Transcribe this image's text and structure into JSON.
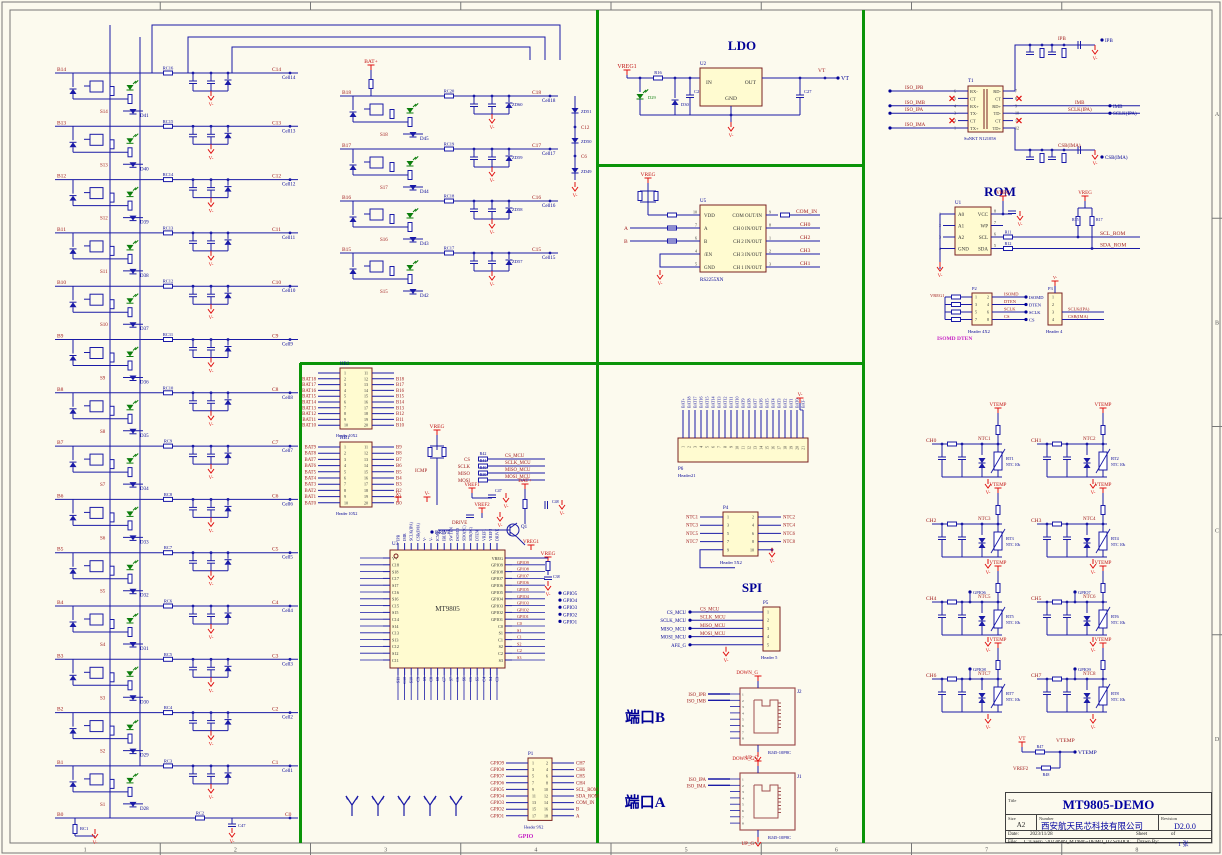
{
  "frame": {
    "bottom_zones": [
      "1",
      "2",
      "3",
      "4",
      "5",
      "6",
      "7",
      "8"
    ],
    "right_zones": [
      "A",
      "B",
      "C",
      "D"
    ]
  },
  "title_block": {
    "title_label": "Title",
    "title": "MT9805-DEMO",
    "size_label": "Size",
    "size": "A2",
    "number_label": "Number",
    "number": "西安航天民芯科技有限公司",
    "revision_label": "Revision",
    "revision": "D2.0.0",
    "date_label": "Date:",
    "date": "2023/11/28",
    "sheet_label": "Sheet",
    "of_label": "of",
    "file_label": "File:",
    "file": "C:\\Users\\..\\20230909_MT9805-DEMO_D2.SchDOC",
    "drawn_label": "Drawn By:",
    "drawn": "1 张"
  },
  "left_stack": {
    "rows": [
      {
        "bus": "B14",
        "s": "S14",
        "d": "D41",
        "rc": "RC16",
        "net": "C14",
        "cell": "Cell14"
      },
      {
        "bus": "B13",
        "s": "S13",
        "d": "D40",
        "rc": "RC15",
        "net": "C13",
        "cell": "Cell13"
      },
      {
        "bus": "B12",
        "s": "S12",
        "d": "D39",
        "rc": "RC14",
        "net": "C12",
        "cell": "Cell12"
      },
      {
        "bus": "B11",
        "s": "S11",
        "d": "D38",
        "rc": "RC13",
        "net": "C11",
        "cell": "Cell11"
      },
      {
        "bus": "B10",
        "s": "S10",
        "d": "D37",
        "rc": "RC12",
        "net": "C10",
        "cell": "Cell10"
      },
      {
        "bus": "B9",
        "s": "S9",
        "d": "D36",
        "rc": "RC11",
        "net": "C9",
        "cell": "Cell9"
      },
      {
        "bus": "B8",
        "s": "S8",
        "d": "D35",
        "rc": "RC10",
        "net": "C8",
        "cell": "Cell8"
      },
      {
        "bus": "B7",
        "s": "S7",
        "d": "D34",
        "rc": "RC9",
        "net": "C7",
        "cell": "Cell7"
      },
      {
        "bus": "B6",
        "s": "S6",
        "d": "D33",
        "rc": "RC8",
        "net": "C6",
        "cell": "Cell6"
      },
      {
        "bus": "B5",
        "s": "S5",
        "d": "D32",
        "rc": "RC7",
        "net": "C5",
        "cell": "Cell5"
      },
      {
        "bus": "B4",
        "s": "S4",
        "d": "D31",
        "rc": "RC6",
        "net": "C4",
        "cell": "Cell4"
      },
      {
        "bus": "B3",
        "s": "S3",
        "d": "D30",
        "rc": "RC5",
        "net": "C3",
        "cell": "Cell3"
      },
      {
        "bus": "B2",
        "s": "S2",
        "d": "D29",
        "rc": "RC4",
        "net": "C2",
        "cell": "Cell2"
      },
      {
        "bus": "B1",
        "s": "S1",
        "d": "D28",
        "rc": "RC3",
        "net": "C1",
        "cell": "Cell1"
      }
    ],
    "b0": {
      "bus": "B0",
      "rc1": "RC1",
      "rc2": "RC2",
      "c47": "C47",
      "net": "C0",
      "gnd": "V-"
    }
  },
  "col2": {
    "bat": "BAT+",
    "rows": [
      {
        "bus": "B18",
        "s": "S18",
        "d": "D45",
        "rc": "RC20",
        "net": "C18",
        "cell": "Cell18",
        "zd": "ZD60"
      },
      {
        "bus": "B17",
        "s": "S17",
        "d": "D44",
        "rc": "RC19",
        "net": "C17",
        "cell": "Cell17",
        "zd": "ZD59"
      },
      {
        "bus": "B16",
        "s": "S16",
        "d": "D43",
        "rc": "RC18",
        "net": "C16",
        "cell": "Cell16",
        "zd": "ZD58"
      },
      {
        "bus": "B15",
        "s": "S15",
        "d": "D42",
        "rc": "RC17",
        "net": "C15",
        "cell": "Cell15",
        "zd": "ZD57"
      }
    ],
    "chain": {
      "zds": [
        "ZD51",
        "ZD50",
        "ZD49"
      ],
      "taps": [
        "C12",
        "C6"
      ],
      "gnd": "V-"
    }
  },
  "ldo": {
    "title": "LDO",
    "ref": "U2",
    "pin_in": "IN",
    "pin_out": "OUT",
    "pin_gnd": "GND",
    "in_net": "VREG1",
    "out_net": "VT",
    "out_port": "VT",
    "r": "R16",
    "led": "D29",
    "zener": "D30",
    "c1": "C26",
    "c2": "C27",
    "gnd": "V-"
  },
  "mux": {
    "ref": "U5",
    "part": "RS2255XN",
    "vdd_net": "VREG",
    "a_net": "A",
    "b_net": "B",
    "gnd": "V-",
    "left_pins": [
      [
        "10",
        "VDD"
      ],
      [
        "7",
        "A"
      ],
      [
        "6",
        "B"
      ],
      [
        "4",
        "/EN"
      ],
      [
        "5",
        "GND"
      ]
    ],
    "right_pins": [
      [
        "9",
        "COM OUT/IN"
      ],
      [
        "8",
        "CH 0 IN/OUT"
      ],
      [
        "1",
        "CH 2 IN/OUT"
      ],
      [
        "2",
        "CH 3 IN/OUT"
      ],
      [
        "3",
        "CH 1 IN/OUT"
      ]
    ],
    "right_nets": [
      "COM_IN",
      "CH0",
      "CH2",
      "CH3",
      "CH1"
    ]
  },
  "xfmr": {
    "ref": "T1",
    "part": "SuNKT N12105S",
    "left_pins": [
      [
        "6",
        "RX-"
      ],
      [
        "5",
        "CT"
      ],
      [
        "4",
        "RX+"
      ],
      [
        "3",
        "TX-"
      ],
      [
        "2",
        "CT"
      ],
      [
        "1",
        "TX+"
      ]
    ],
    "right_pins": [
      [
        "7",
        "RD-"
      ],
      [
        "8",
        "CT"
      ],
      [
        "9",
        "RD+"
      ],
      [
        "10",
        "TD-"
      ],
      [
        "11",
        "CT"
      ],
      [
        "12",
        "TD+"
      ]
    ],
    "left_nets": [
      "ISO_IPB",
      "ISO_IMB",
      "ISO_IPA",
      "ISO_IMA"
    ],
    "right_nets": [
      "IPB",
      "IMB",
      "SCLK(IPA)",
      "CSB(IMA)"
    ],
    "gnd": "V-"
  },
  "rom": {
    "title": "ROM",
    "ref": "U1",
    "left_pins": [
      [
        "1",
        "A0"
      ],
      [
        "2",
        "A1"
      ],
      [
        "3",
        "A2"
      ],
      [
        "4",
        "GND"
      ]
    ],
    "right_pins": [
      [
        "8",
        "VCC"
      ],
      [
        "7",
        "WP"
      ],
      [
        "6",
        "SCL"
      ],
      [
        "5",
        "SDA"
      ]
    ],
    "vreg": "VREG",
    "r_scl": "R11",
    "r_sda": "R12",
    "r_pu1": "R15",
    "r_pu2": "R17",
    "net_scl": "SCL_ROM",
    "net_sda": "SDA_ROM",
    "gnd": "V-"
  },
  "iso_hdrs": {
    "p2": {
      "ref": "P2",
      "part": "Header 4X2",
      "nets": [
        "ISOMD",
        "DTEN",
        "SCLK",
        "CS"
      ],
      "left_net": "VREG1"
    },
    "p3": {
      "ref": "P3",
      "part": "Header 4",
      "nets": [
        "SCLK(IPA)",
        "CSB(IMA)"
      ],
      "top": "V-"
    },
    "caption": "ISOMD   DTEN"
  },
  "mcu": {
    "hb2": {
      "ref": "HB2",
      "part": "Header 10X2",
      "left": [
        "BAT18",
        "BAT17",
        "BAT16",
        "BAT15",
        "BAT14",
        "BAT13",
        "BAT12",
        "BAT11",
        "BAT10"
      ],
      "right": [
        "B18",
        "B17",
        "B16",
        "B15",
        "B14",
        "B13",
        "B12",
        "B11",
        "B10"
      ]
    },
    "hb1": {
      "ref": "HB1",
      "part": "Header 10X2",
      "left": [
        "BAT9",
        "BAT8",
        "BAT7",
        "BAT6",
        "BAT5",
        "BAT4",
        "BAT3",
        "BAT2",
        "BAT1",
        "BAT0"
      ],
      "right": [
        "B9",
        "B8",
        "B7",
        "B6",
        "B5",
        "B4",
        "B3",
        "B2",
        "B1",
        "B0"
      ]
    },
    "chip": {
      "ref": "U3",
      "name": "MT9805",
      "left": [
        "V+",
        "C18",
        "S18",
        "C17",
        "S17",
        "C16",
        "S16",
        "C15",
        "S15",
        "C14",
        "S14",
        "C13",
        "S13",
        "C12",
        "S12",
        "C11"
      ],
      "right": [
        "VREG",
        "GPIO9",
        "GPIO8",
        "GPIO7",
        "GPIO6",
        "GPIO5",
        "GPIO4",
        "GPIO3",
        "GPIO2",
        "GPIO1",
        "C0",
        "S1",
        "C1",
        "S2",
        "C2",
        "S3"
      ],
      "top": [
        "IPB",
        "IMB",
        "SCLK(IPA)",
        "CSB(IMA)",
        "V-",
        "V-",
        "ICMP",
        "IBIAS",
        "SWTEN",
        "ISOMD",
        "SDO(SC)",
        "SDI(SC)",
        "DTEN",
        "VREF1",
        "VREF2",
        "DRIVE"
      ],
      "bottom": [
        "S11",
        "C10",
        "S10",
        "C9",
        "S9",
        "C8",
        "S8",
        "C7",
        "S7",
        "C6",
        "S6",
        "C5",
        "S5",
        "C4",
        "S4",
        "C3"
      ]
    },
    "mcu_rows": [
      [
        "CS",
        "R42",
        "CS_MCU"
      ],
      [
        "SCLK",
        "R41",
        "SCLK_MCU"
      ],
      [
        "MISO",
        "R40",
        "MISO_MCU"
      ],
      [
        "MOSI",
        "R39",
        "MOSI_MCU"
      ]
    ],
    "vreg": "VREG",
    "icmp": "ICMP",
    "vref1": "VREF1",
    "vref2": "VREF2",
    "c47": "C47",
    "drive_net": "DRIVE",
    "drive_port": "DRIVE",
    "q": "Q1",
    "bat": "BAT+",
    "c48": "C48",
    "vreg1": "VREG1",
    "r44": "R44",
    "c38": "C38",
    "gnd": "V-",
    "gpio_ports": [
      "GPIO5",
      "GPIO4",
      "GPIO3",
      "GPIO2",
      "GPIO1"
    ],
    "p1": {
      "ref": "P1",
      "part": "Header 9X2",
      "caption": "GPIO",
      "left": [
        "GPIO9",
        "GPIO8",
        "GPIO7",
        "GPIO6",
        "GPIO5",
        "GPIO4",
        "GPIO3",
        "GPIO2",
        "GPIO1"
      ],
      "right": [
        "CH7",
        "CH6",
        "CH5",
        "CH4",
        "SCL_ROM",
        "SDA_ROM",
        "COM_IN",
        "B",
        "A"
      ]
    }
  },
  "mid": {
    "p6": {
      "ref": "P6",
      "part": "Header21",
      "gnd": "V-",
      "labels": [
        "BAT+",
        "BAT18",
        "BAT17",
        "BAT16",
        "BAT15",
        "BAT14",
        "BAT13",
        "BAT12",
        "BAT11",
        "BAT10",
        "BAT9",
        "BAT8",
        "BAT7",
        "BAT6",
        "BAT5",
        "BAT4",
        "BAT3",
        "BAT2",
        "BAT1",
        "BAT0",
        "BAT-"
      ]
    },
    "p4": {
      "ref": "P4",
      "part": "Header 5X2",
      "gnd": "V-",
      "left": [
        "NTC1",
        "NTC3",
        "NTC5",
        "NTC7"
      ],
      "right": [
        "NTC2",
        "NTC4",
        "NTC6",
        "NTC8"
      ]
    },
    "spi_title": "SPI",
    "p5": {
      "ref": "P5",
      "part": "Header 5",
      "gnd": "V-",
      "ports": [
        "CS_MCU",
        "SCLK_MCU",
        "MISO_MCU",
        "MOSI_MCU",
        "AFE_G"
      ],
      "nets": [
        "CS_MCU",
        "SCLK_MCU",
        "MISO_MCU",
        "MOSI_MCU"
      ]
    },
    "portB": {
      "label": "端口B",
      "ref": "J2",
      "part": "RJ45-10P8C",
      "top": "DOWN_G",
      "bottom": "DOWN_G",
      "nets": [
        "ISO_IPB",
        "ISO_IMB"
      ]
    },
    "portA": {
      "label": "端口A",
      "ref": "J1",
      "part": "RJ45-10P8C",
      "top": "UP_G",
      "bottom": "UP_G",
      "nets": [
        "ISO_IPA",
        "ISO_IMA"
      ]
    }
  },
  "ntc": {
    "vtemp": "VTEMP",
    "ntc_val": "NTC 10k",
    "gnd": "V-",
    "blocks": [
      {
        "ch": "CH0",
        "ntc": "NTC1",
        "rt": "RT1"
      },
      {
        "ch": "CH1",
        "ntc": "NTC2",
        "rt": "RT2"
      },
      {
        "ch": "CH2",
        "ntc": "NTC3",
        "rt": "RT3"
      },
      {
        "ch": "CH3",
        "ntc": "NTC4",
        "rt": "RT4"
      },
      {
        "ch": "CH4",
        "ntc": "NTC5",
        "rt": "RT5",
        "gpio": "GPIO6"
      },
      {
        "ch": "CH5",
        "ntc": "NTC6",
        "rt": "RT6",
        "gpio": "GPIO7"
      },
      {
        "ch": "CH6",
        "ntc": "NTC7",
        "rt": "RT7",
        "gpio": "GPIO8"
      },
      {
        "ch": "CH7",
        "ntc": "NTC8",
        "rt": "RT8",
        "gpio": "GPIO9"
      }
    ]
  },
  "vdiv": {
    "vt": "VT",
    "r1": "R47",
    "vtemp_net": "VTEMP",
    "vtemp_port": "VTEMP",
    "vref2": "VREF2",
    "r2": "R48"
  }
}
